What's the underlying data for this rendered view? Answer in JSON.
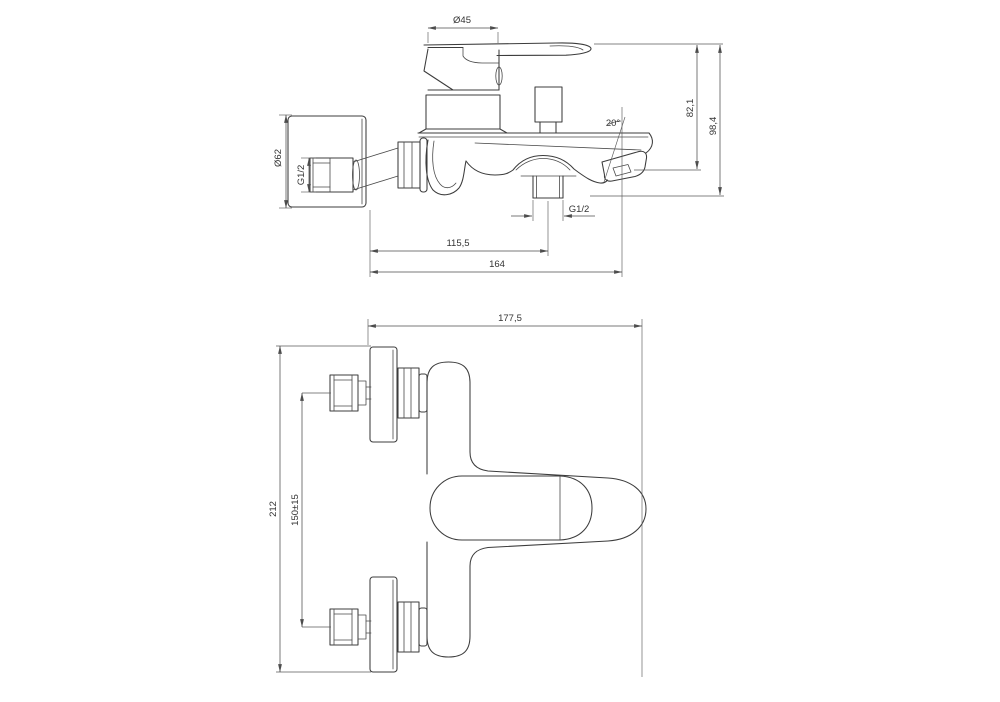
{
  "drawing": {
    "background": "#ffffff",
    "line_color": "#3c3c3c",
    "dimension_color": "#4d4d4d",
    "side_view": {
      "dims": {
        "handle_diameter": "Ø45",
        "spout_height": "82,1",
        "overall_height": "98,4",
        "spout_angle": "20°",
        "plate_diameter": "Ø62",
        "inlet_thread": "G1/2",
        "shower_thread": "G1/2",
        "shower_offset": "115,5",
        "spout_reach": "164"
      }
    },
    "plan_view": {
      "dims": {
        "overall_width": "177,5",
        "overall_span": "212",
        "inlet_spacing": "150±15"
      }
    }
  }
}
